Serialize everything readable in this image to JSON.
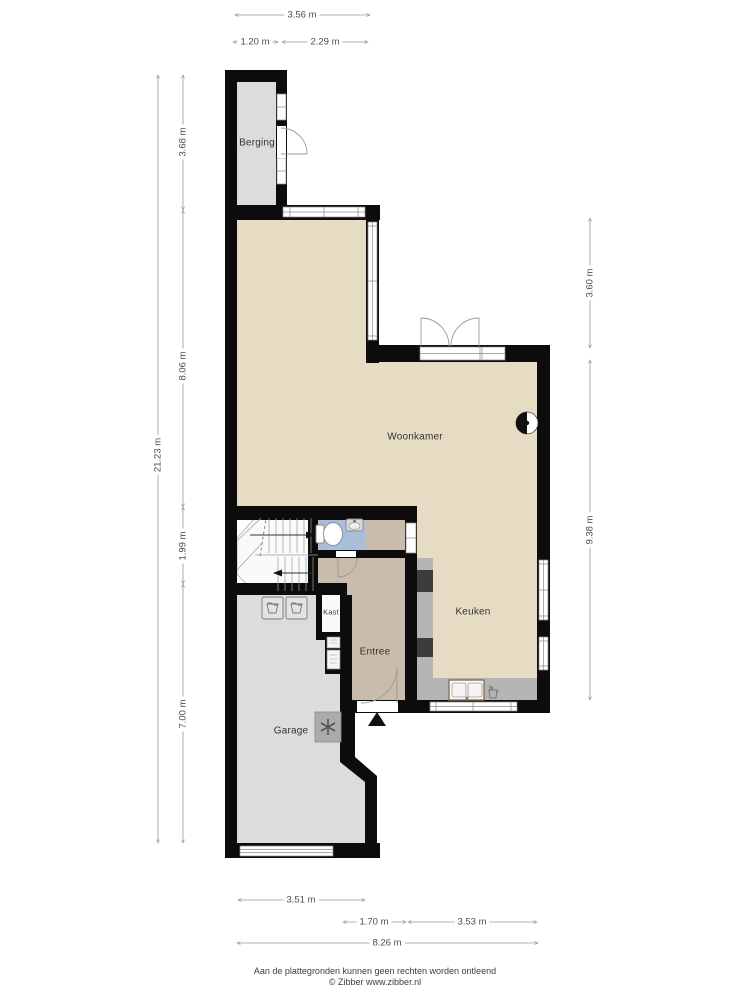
{
  "page": {
    "footer_line1": "Aan de plattegronden kunnen geen rechten worden ontleend",
    "footer_line2": "© Zibber www.zibber.nl"
  },
  "rooms": {
    "berging": "Berging",
    "woonkamer": "Woonkamer",
    "keuken": "Keuken",
    "kast": "Kast",
    "entree": "Entree",
    "garage": "Garage"
  },
  "dimensions": {
    "top_total": "3.56 m",
    "top_berging": "1.20 m",
    "top_woonkamer": "2.29 m",
    "left_berging": "3.68 m",
    "left_woonkamer": "8.06 m",
    "left_total": "21.23 m",
    "left_hal": "1.99 m",
    "left_garage": "7.00 m",
    "right_woonkamer": "3.60 m",
    "right_keuken": "9.38 m",
    "bottom_garage": "3.51 m",
    "bottom_entree": "1.70 m",
    "bottom_keuken": "3.53 m",
    "bottom_total": "8.26 m"
  },
  "icons": {
    "entrance_marker": "entrance-arrow-icon",
    "mechanical_ventilation": "fan-icon",
    "flue": "flue-icon",
    "laundry": "washing-machine-icon",
    "boiler": "kettle-icon",
    "meter_cabinet": "meter-icon",
    "toilet": "toilet-icon",
    "hand_basin": "basin-icon",
    "kitchen_sink": "sink-icon"
  },
  "colors": {
    "wall": "#0c0c0c",
    "floor_living": "#e5dcc3",
    "floor_entree": "#c9bcac",
    "floor_toilet": "#a9bed9",
    "floor_storage": "#dcdcdc",
    "counter": "#b5b5b5",
    "appliance": "#3c3c3c",
    "dimension_line": "#999999",
    "dimension_text": "#4d4d4d",
    "label_text": "#333333"
  }
}
